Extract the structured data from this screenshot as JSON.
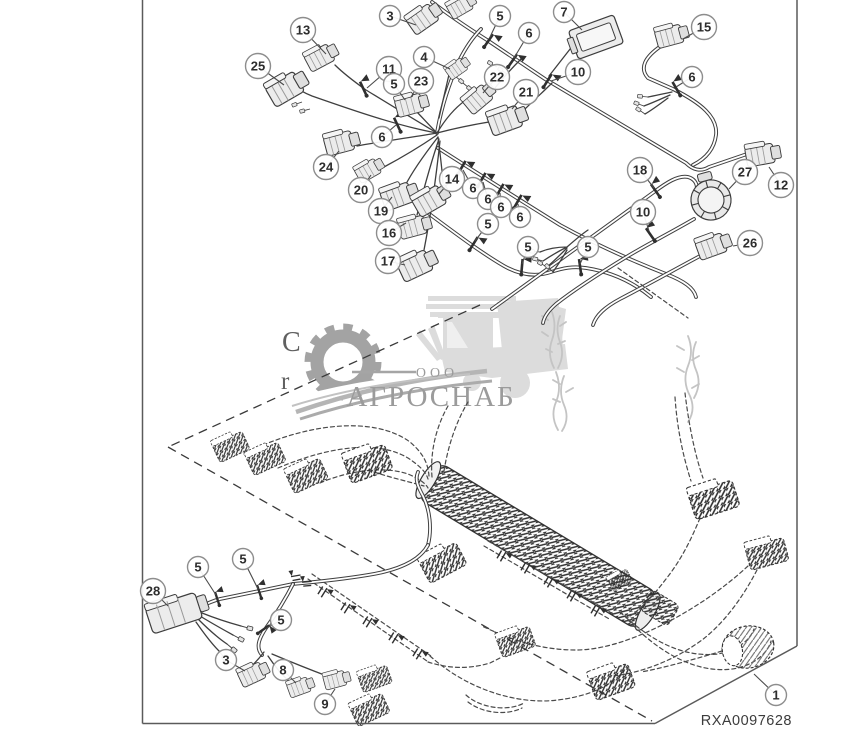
{
  "figure": {
    "id_label": "RXA0097628"
  },
  "watermark": {
    "ooo": "ООО",
    "brand": "АГРОСНАБ",
    "partial_letter_1": "C",
    "partial_letter_2": "r",
    "brand_color": "#9b9b9b"
  },
  "colors": {
    "line": "#3f3f3f",
    "frame": "#5a5a5a",
    "balloon_stroke": "#8d8d8d"
  },
  "callouts": [
    {
      "n": "13",
      "cx": 303,
      "cy": 30,
      "tx": 326,
      "ty": 54
    },
    {
      "n": "3",
      "cx": 390,
      "cy": 16,
      "tx": 416,
      "ty": 25
    },
    {
      "n": "5",
      "cx": 500,
      "cy": 16,
      "tx": 490,
      "ty": 37
    },
    {
      "n": "7",
      "cx": 564,
      "cy": 12,
      "tx": 582,
      "ty": 30
    },
    {
      "n": "15",
      "cx": 704,
      "cy": 27,
      "tx": 683,
      "ty": 39
    },
    {
      "n": "4",
      "cx": 424,
      "cy": 57,
      "tx": 450,
      "ty": 69
    },
    {
      "n": "6",
      "cx": 529,
      "cy": 33,
      "tx": 514,
      "ty": 58
    },
    {
      "n": "25",
      "cx": 258,
      "cy": 66,
      "tx": 284,
      "ty": 85
    },
    {
      "n": "11",
      "cx": 389,
      "cy": 69,
      "tx": 367,
      "ty": 88
    },
    {
      "n": "10",
      "cx": 578,
      "cy": 72,
      "tx": 551,
      "ty": 81
    },
    {
      "n": "6",
      "cx": 692,
      "cy": 77,
      "tx": 676,
      "ty": 87
    },
    {
      "n": "5",
      "cx": 394,
      "cy": 84,
      "tx": 405,
      "ty": 100
    },
    {
      "n": "23",
      "cx": 421,
      "cy": 81,
      "tx": 411,
      "ty": 97
    },
    {
      "n": "22",
      "cx": 497,
      "cy": 77,
      "tx": 483,
      "ty": 93
    },
    {
      "n": "21",
      "cx": 526,
      "cy": 92,
      "tx": 512,
      "ty": 109
    },
    {
      "n": "6",
      "cx": 382,
      "cy": 137,
      "tx": 396,
      "ty": 125
    },
    {
      "n": "24",
      "cx": 326,
      "cy": 167,
      "tx": 339,
      "ty": 151
    },
    {
      "n": "20",
      "cx": 361,
      "cy": 190,
      "tx": 371,
      "ty": 175
    },
    {
      "n": "19",
      "cx": 381,
      "cy": 211,
      "tx": 392,
      "ty": 197
    },
    {
      "n": "16",
      "cx": 389,
      "cy": 233,
      "tx": 406,
      "ty": 223
    },
    {
      "n": "17",
      "cx": 388,
      "cy": 261,
      "tx": 405,
      "ty": 265
    },
    {
      "n": "14",
      "cx": 452,
      "cy": 179,
      "tx": 439,
      "ty": 194
    },
    {
      "n": "6",
      "cx": 473,
      "cy": 188,
      "tx": 463,
      "ty": 170
    },
    {
      "n": "6",
      "cx": 488,
      "cy": 199,
      "tx": 483,
      "ty": 182
    },
    {
      "n": "6",
      "cx": 501,
      "cy": 207,
      "tx": 500,
      "ty": 193
    },
    {
      "n": "6",
      "cx": 520,
      "cy": 217,
      "tx": 518,
      "ty": 204
    },
    {
      "n": "18",
      "cx": 640,
      "cy": 170,
      "tx": 654,
      "ty": 188
    },
    {
      "n": "10",
      "cx": 643,
      "cy": 212,
      "tx": 649,
      "ty": 231
    },
    {
      "n": "27",
      "cx": 745,
      "cy": 172,
      "tx": 729,
      "ty": 189
    },
    {
      "n": "12",
      "cx": 781,
      "cy": 185,
      "tx": 769,
      "ty": 167
    },
    {
      "n": "26",
      "cx": 750,
      "cy": 243,
      "tx": 733,
      "ty": 246
    },
    {
      "n": "5",
      "cx": 488,
      "cy": 224,
      "tx": 475,
      "ty": 241
    },
    {
      "n": "5",
      "cx": 528,
      "cy": 247,
      "tx": 522,
      "ty": 264
    },
    {
      "n": "5",
      "cx": 588,
      "cy": 247,
      "tx": 580,
      "ty": 264
    },
    {
      "n": "28",
      "cx": 153,
      "cy": 591,
      "tx": 168,
      "ty": 606
    },
    {
      "n": "5",
      "cx": 198,
      "cy": 567,
      "tx": 216,
      "ty": 595
    },
    {
      "n": "5",
      "cx": 243,
      "cy": 559,
      "tx": 258,
      "ty": 589
    },
    {
      "n": "5",
      "cx": 281,
      "cy": 620,
      "tx": 267,
      "ty": 628
    },
    {
      "n": "3",
      "cx": 226,
      "cy": 660,
      "tx": 245,
      "ty": 671
    },
    {
      "n": "8",
      "cx": 283,
      "cy": 670,
      "tx": 296,
      "ty": 683
    },
    {
      "n": "9",
      "cx": 325,
      "cy": 704,
      "tx": 335,
      "ty": 689
    },
    {
      "n": "1",
      "cx": 776,
      "cy": 695,
      "tx": 754,
      "ty": 674
    }
  ]
}
